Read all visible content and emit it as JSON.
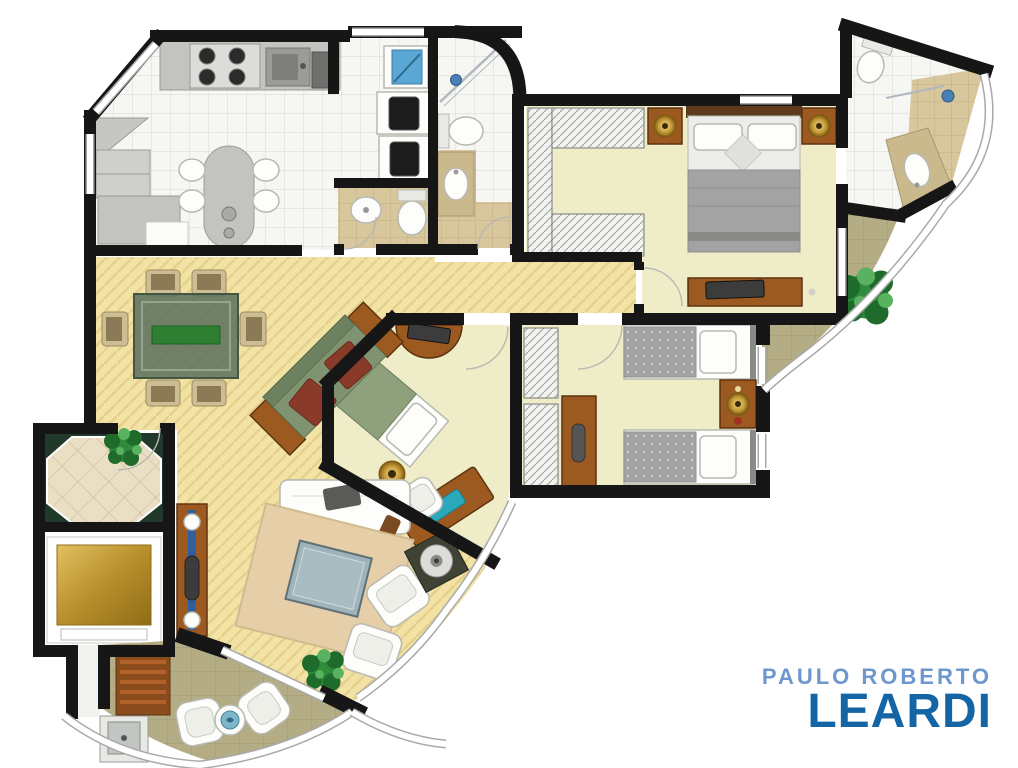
{
  "brand": {
    "line1": "PAULO ROBERTO",
    "line2": "LEARDI"
  },
  "rooms": [
    "kitchen",
    "service-area",
    "maid-wc",
    "bathroom",
    "master-bedroom",
    "ensuite-bathroom",
    "master-balcony",
    "hallway",
    "bedroom-3",
    "twin-bedroom",
    "living-dining-room",
    "entry-hall",
    "elevator",
    "gourmet-balcony"
  ],
  "colors": {
    "wall": "#161616",
    "logo_light": "#6d97cd",
    "logo_dark": "#1465a5",
    "wood_base": "#f2e2a4",
    "wood_stripe": "#e5cf8c",
    "tile_white": "#f6f6f3",
    "tile_line": "#d8d8d2",
    "tile_beige": "#d8c69c",
    "tile_beige_line": "#c1ae83",
    "bedroom_floor": "#efecc8",
    "balcony_tile": "#b4ac84",
    "balcony_line": "#a19872",
    "marble": "#ebdfc3",
    "marble_line": "#cabc9b",
    "green_marble": "#21392a",
    "furniture_wood": "#9c5a20",
    "furniture_wood_dark": "#5f3310",
    "granite": "#c3c3c0",
    "granite_dark": "#9a9a96",
    "white_furniture": "#fdfdfb",
    "sofa_green": "#7f9370",
    "cushion_red": "#8a3a28",
    "quilt_gray": "#a3a3a3",
    "glass_teal": "#2aa9bd",
    "glass_blue": "#5aa7d6",
    "plant": "#2f8c3c",
    "rug": "#e6cfa8",
    "coffee_glass": "#9fb3bb",
    "lamp_gold": "#c89a3a"
  }
}
